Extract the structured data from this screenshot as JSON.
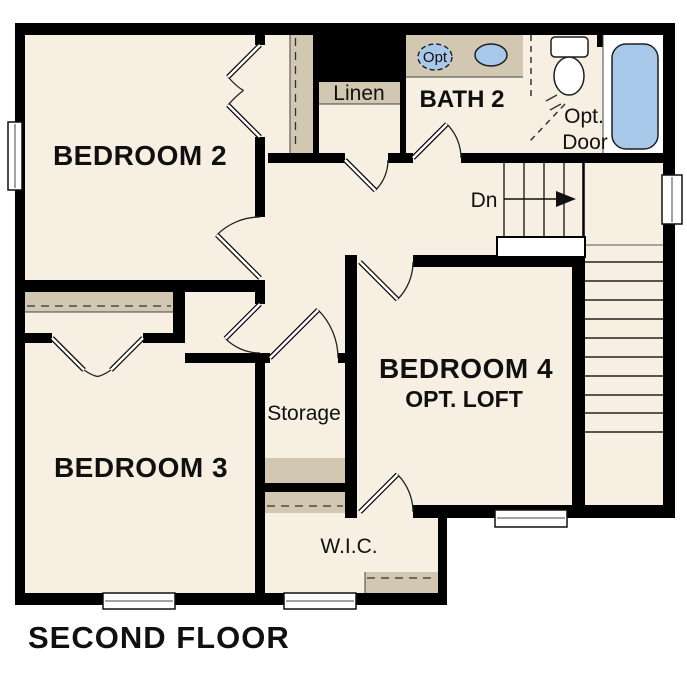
{
  "title": "SECOND FLOOR",
  "rooms": {
    "bedroom2": "BEDROOM 2",
    "bedroom3": "BEDROOM 3",
    "bedroom4": "BEDROOM 4",
    "bedroom4_sub": "OPT. LOFT",
    "bath2": "BATH 2",
    "linen": "Linen",
    "storage": "Storage",
    "wic": "W.I.C."
  },
  "stairs": {
    "down_label": "Dn",
    "upper_flight_treads": 5,
    "side_flight_treads": 11,
    "direction": "down-to-first-floor"
  },
  "fixtures": {
    "optional_sink_label": "Opt",
    "optional_door_line1": "Opt.",
    "optional_door_line2": "Door",
    "bath_fixture_icons": [
      "vanity-sink-icon",
      "optional-sink-icon",
      "toilet-icon",
      "bathtub-icon"
    ]
  },
  "windows_count": 5,
  "colors": {
    "floor": "#f6efe2",
    "accent_tan": "#d2c7b1",
    "fixture_blue": "#a8c8ea",
    "wall": "#000000",
    "text": "#101010",
    "background": "#ffffff"
  }
}
